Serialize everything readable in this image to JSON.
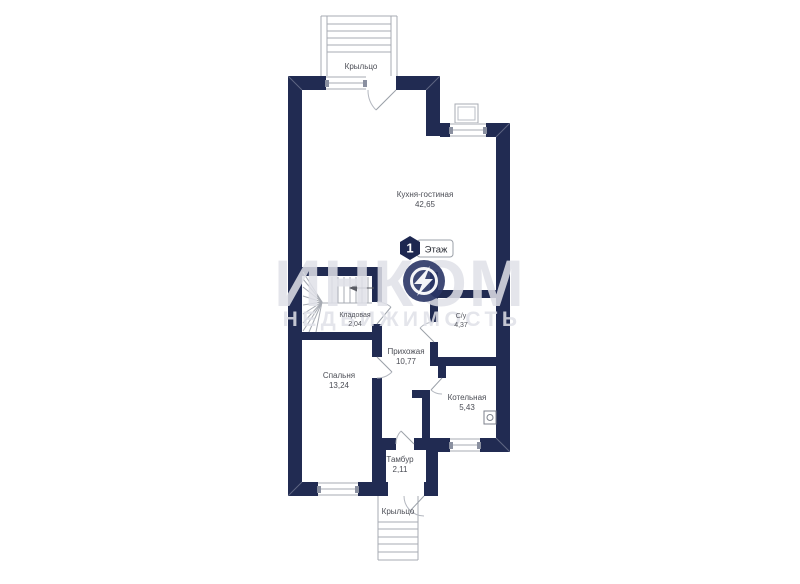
{
  "floor_badge": {
    "number": "1",
    "label": "Этаж"
  },
  "watermark": {
    "brand": "ИНКОМ",
    "subtitle": "НЕДВИЖИМОСТЬ"
  },
  "rooms": {
    "kitchen": {
      "name": "Кухня-гостиная",
      "area": "42,65"
    },
    "storage": {
      "name": "Кладовая",
      "area": "2,04"
    },
    "bathroom": {
      "name": "С/у",
      "area": "4,37"
    },
    "hallway": {
      "name": "Прихожая",
      "area": "10,77"
    },
    "bedroom": {
      "name": "Спальня",
      "area": "13,24"
    },
    "boiler": {
      "name": "Котельная",
      "area": "5,43"
    },
    "tambour": {
      "name": "Тамбур",
      "area": "2,11"
    }
  },
  "porches": {
    "top": "Крыльцо",
    "bottom": "Крыльцо"
  },
  "colors": {
    "wall": "#212b52",
    "background": "#ffffff",
    "line": "#a7abb3",
    "label": "#4b4d55",
    "watermark": "#dfe0e8",
    "logo": "#2a3566"
  }
}
